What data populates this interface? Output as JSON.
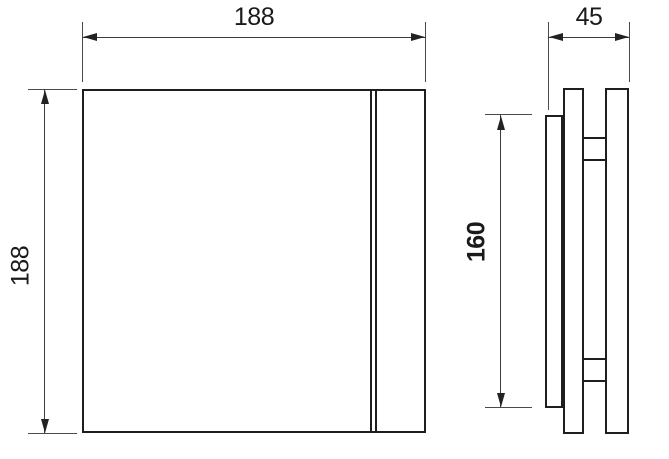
{
  "drawing": {
    "background_color": "#ffffff",
    "object_line_color": "#1e1e1e",
    "dimension_line_color": "#3d3d3d",
    "text_color": "#1a1a1a",
    "front_view": {
      "width": {
        "label": "188"
      },
      "height": {
        "label": "188"
      }
    },
    "side_view": {
      "depth": {
        "label": "45"
      },
      "inner_height": {
        "label": "160"
      }
    }
  }
}
